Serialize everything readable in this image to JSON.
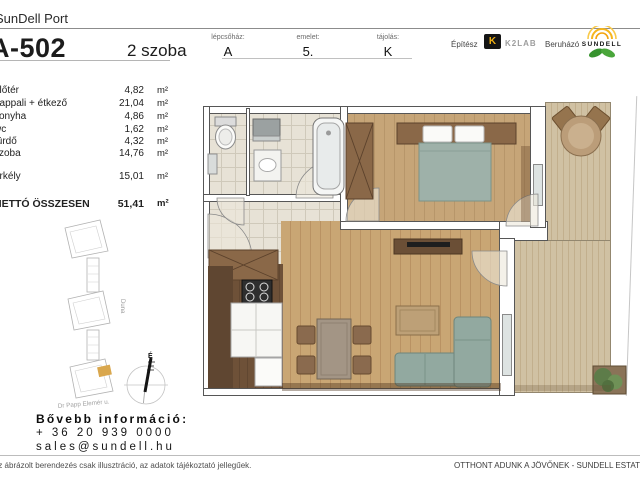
{
  "header": {
    "brand": "SunDell Port",
    "unit_id": "A-502",
    "unit_type": "2 szoba",
    "info": [
      {
        "label": "lépcsőház:",
        "value": "A"
      },
      {
        "label": "emelet:",
        "value": "5."
      },
      {
        "label": "tájolás:",
        "value": "K"
      }
    ],
    "architect_label": "Építész",
    "architect_logo_letter": "K",
    "architect_name": "K2LAB",
    "developer_label": "Beruházó",
    "developer_name": "SUNDELL"
  },
  "area_table": {
    "rows": [
      {
        "name": "előtér",
        "value": "4,82",
        "unit": "m²"
      },
      {
        "name": "nappali + étkező",
        "value": "21,04",
        "unit": "m²"
      },
      {
        "name": "konyha",
        "value": "4,86",
        "unit": "m²"
      },
      {
        "name": "wc",
        "value": "1,62",
        "unit": "m²"
      },
      {
        "name": "fürdő",
        "value": "4,32",
        "unit": "m²"
      },
      {
        "name": "szoba",
        "value": "14,76",
        "unit": "m²"
      }
    ],
    "balcony_row": {
      "name": "erkély",
      "value": "15,01",
      "unit": "m²"
    },
    "total_row": {
      "name": "NETTÓ ÖSSZESEN",
      "value": "51,41",
      "unit": "m²"
    }
  },
  "site_plan": {
    "river_label": "Duna",
    "street_label": "Dr Papp Elemér u.",
    "compass_label": "É"
  },
  "contact": {
    "heading": "Bővebb információ:",
    "phone": "+ 36 20 939 0000",
    "email": "sales@sundell.hu"
  },
  "footer": {
    "disclaimer": "Az ábrázolt berendezés csak illusztráció, az adatok tájékoztató jellegűek.",
    "slogan": "OTTHONT ADUNK A JÖVŐNEK - SUNDELL ESTATE NYRT."
  },
  "colors": {
    "wood_floor": "#c6a578",
    "balcony_deck": "#d0c1a3",
    "tile": "#e7e2d6",
    "sofa_teal": "#92a9a0",
    "furniture_brown": "#8a6848",
    "kitchen_dark": "#6e5138",
    "highlight_orange": "#d9a74e",
    "logo_yellow": "#f0b014",
    "logo_green": "#3f9b35"
  }
}
